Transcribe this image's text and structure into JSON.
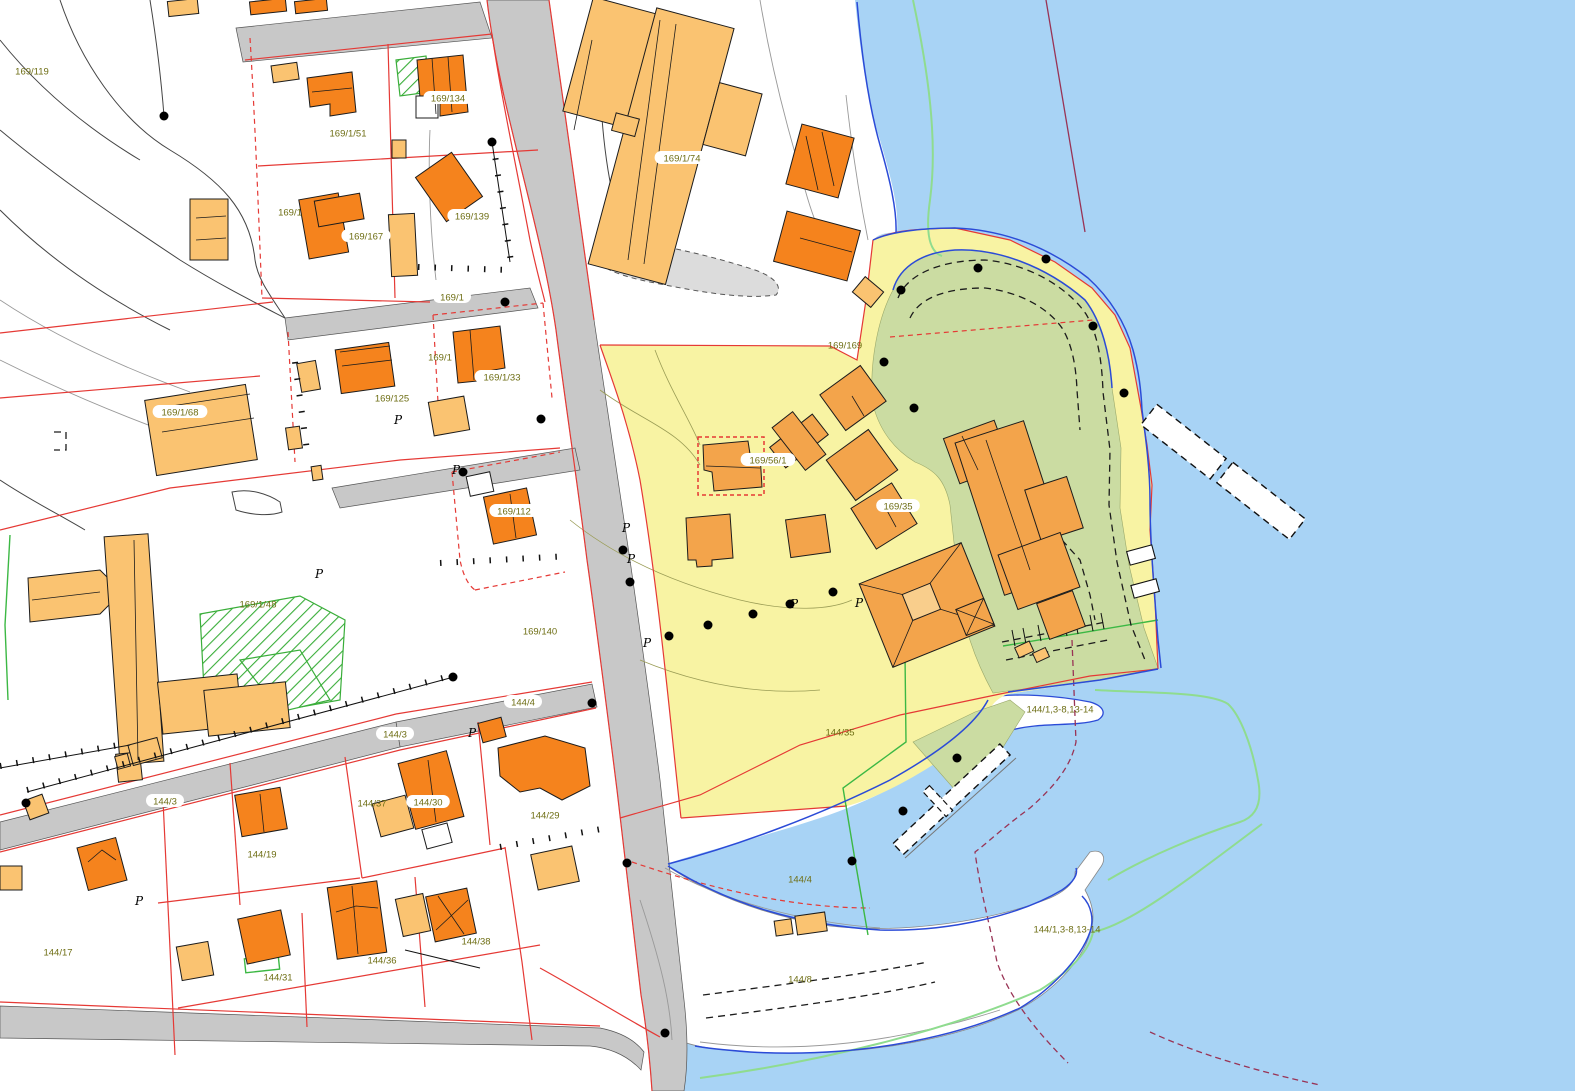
{
  "map": {
    "kind": "cadastral-zoning-map",
    "colors": {
      "water": "#A8D3F5",
      "zone_yellow": "#F8F3A3",
      "zone_green": "#CBDCA2",
      "building_dark": "#F5831D",
      "building_medium": "#F3A44B",
      "building_light": "#FAC371",
      "road_gray": "#C8C8C8",
      "boundary_red": "#E53935",
      "boundary_maroon": "#993355",
      "shore_blue": "#2B4BD7",
      "line_green": "#3CB844",
      "offshore_green": "#8FDC8F",
      "label_olive": "#6E6E14"
    },
    "parcel_labels": [
      {
        "text": "169/119",
        "x": 32,
        "y": 71,
        "halo": false
      },
      {
        "text": "169/1/51",
        "x": 348,
        "y": 133,
        "halo": false
      },
      {
        "text": "169/1",
        "x": 290,
        "y": 212,
        "halo": false
      },
      {
        "text": "169/1",
        "x": 440,
        "y": 357,
        "halo": false
      },
      {
        "text": "169/125",
        "x": 392,
        "y": 398,
        "halo": false
      },
      {
        "text": "169/1/68",
        "x": 180,
        "y": 412,
        "halo": true
      },
      {
        "text": "169/1/48",
        "x": 258,
        "y": 604,
        "halo": false
      },
      {
        "text": "169/140",
        "x": 540,
        "y": 631,
        "halo": false
      },
      {
        "text": "169/169",
        "x": 845,
        "y": 345,
        "halo": false
      },
      {
        "text": "144/35",
        "x": 840,
        "y": 732,
        "halo": false
      },
      {
        "text": "144/1,3-8,13-14",
        "x": 1060,
        "y": 709,
        "halo": false
      },
      {
        "text": "144/1,3-8,13-14",
        "x": 1067,
        "y": 929,
        "halo": false
      },
      {
        "text": "144/4",
        "x": 800,
        "y": 879,
        "halo": false
      },
      {
        "text": "144/8",
        "x": 800,
        "y": 979,
        "halo": false
      },
      {
        "text": "144/19",
        "x": 262,
        "y": 854,
        "halo": false
      },
      {
        "text": "144/37",
        "x": 372,
        "y": 803,
        "halo": false
      },
      {
        "text": "144/29",
        "x": 545,
        "y": 815,
        "halo": false
      },
      {
        "text": "144/17",
        "x": 58,
        "y": 952,
        "halo": false
      },
      {
        "text": "144/31",
        "x": 278,
        "y": 977,
        "halo": false
      },
      {
        "text": "144/36",
        "x": 382,
        "y": 960,
        "halo": false
      },
      {
        "text": "144/38",
        "x": 476,
        "y": 941,
        "halo": false
      },
      {
        "text": "169/134",
        "x": 448,
        "y": 98,
        "halo": true
      },
      {
        "text": "169/139",
        "x": 472,
        "y": 216,
        "halo": true
      },
      {
        "text": "169/167",
        "x": 366,
        "y": 236,
        "halo": true
      },
      {
        "text": "169/1/33",
        "x": 502,
        "y": 377,
        "halo": true
      },
      {
        "text": "169/112",
        "x": 514,
        "y": 511,
        "halo": true
      },
      {
        "text": "169/56/1",
        "x": 768,
        "y": 460,
        "halo": true
      },
      {
        "text": "169/35",
        "x": 898,
        "y": 506,
        "halo": true
      },
      {
        "text": "144/30",
        "x": 428,
        "y": 802,
        "halo": true
      },
      {
        "text": "169/1/74",
        "x": 682,
        "y": 158,
        "halo": true
      }
    ],
    "road_labels": [
      {
        "text": "169/1",
        "x": 452,
        "y": 297
      },
      {
        "text": "144/4",
        "x": 523,
        "y": 702
      },
      {
        "text": "144/3",
        "x": 395,
        "y": 734
      },
      {
        "text": "144/3",
        "x": 165,
        "y": 801
      }
    ],
    "boundary_points": [
      [
        164,
        116
      ],
      [
        492,
        142
      ],
      [
        505,
        302
      ],
      [
        541,
        419
      ],
      [
        463,
        472
      ],
      [
        453,
        677
      ],
      [
        592,
        703
      ],
      [
        26,
        803
      ],
      [
        623,
        550
      ],
      [
        630,
        582
      ],
      [
        669,
        636
      ],
      [
        708,
        625
      ],
      [
        753,
        614
      ],
      [
        790,
        604
      ],
      [
        833,
        592
      ],
      [
        884,
        362
      ],
      [
        914,
        408
      ],
      [
        901,
        290
      ],
      [
        978,
        268
      ],
      [
        1046,
        259
      ],
      [
        1093,
        326
      ],
      [
        1124,
        393
      ],
      [
        957,
        758
      ],
      [
        903,
        811
      ],
      [
        852,
        861
      ],
      [
        627,
        863
      ],
      [
        665,
        1033
      ]
    ],
    "parking_symbols": [
      [
        394,
        424
      ],
      [
        452,
        474
      ],
      [
        315,
        578
      ],
      [
        135,
        905
      ],
      [
        468,
        737
      ],
      [
        643,
        647
      ],
      [
        627,
        563
      ],
      [
        622,
        532
      ],
      [
        790,
        608
      ],
      [
        855,
        607
      ]
    ],
    "parking_glyph": "P"
  }
}
